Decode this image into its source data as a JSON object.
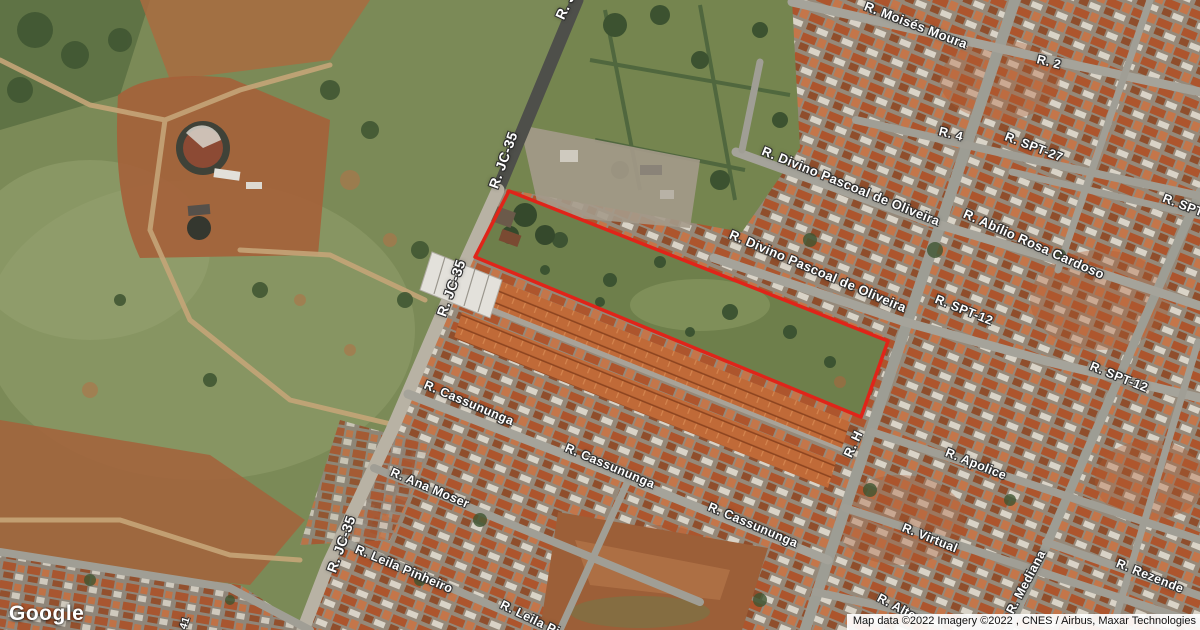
{
  "map": {
    "google_logo": "Google",
    "attribution": "Map data ©2022 Imagery ©2022 , CNES / Airbus, Maxar Technologies",
    "highlight": {
      "color": "#e02419",
      "points": [
        [
          509,
          191
        ],
        [
          888,
          341
        ],
        [
          861,
          417
        ],
        [
          475,
          257
        ]
      ]
    },
    "street_labels": [
      {
        "text": "R. Moisés Moura",
        "x": 916,
        "y": 25,
        "rot": 21,
        "size": 13
      },
      {
        "text": "R. 2",
        "x": 1049,
        "y": 62,
        "rot": 14,
        "size": 12.5
      },
      {
        "text": "R. 4",
        "x": 951,
        "y": 134,
        "rot": 14,
        "size": 12.5
      },
      {
        "text": "R. SPT-27",
        "x": 1034,
        "y": 147,
        "rot": 21,
        "size": 12.5
      },
      {
        "text": "R. SPT-",
        "x": 1185,
        "y": 206,
        "rot": 21,
        "size": 12.5
      },
      {
        "text": "R. Divino Pascoal de Oliveira",
        "x": 851,
        "y": 186,
        "rot": 22,
        "size": 13
      },
      {
        "text": "R. Divino Pascoal de Oliveira",
        "x": 818,
        "y": 271,
        "rot": 23,
        "size": 13
      },
      {
        "text": "R. Abílio Rosa Cardoso",
        "x": 1034,
        "y": 244,
        "rot": 24,
        "size": 13
      },
      {
        "text": "R. SPT-12",
        "x": 964,
        "y": 310,
        "rot": 22,
        "size": 12.5
      },
      {
        "text": "R. SPT-12",
        "x": 1119,
        "y": 377,
        "rot": 22,
        "size": 12.5
      },
      {
        "text": "R. J",
        "x": 565,
        "y": 6,
        "rot": -65,
        "size": 14
      },
      {
        "text": "R. JC-35",
        "x": 503,
        "y": 160,
        "rot": -70,
        "size": 14
      },
      {
        "text": "R. JC-35",
        "x": 451,
        "y": 288,
        "rot": -70,
        "size": 14
      },
      {
        "text": "R. JC-35",
        "x": 341,
        "y": 544,
        "rot": -70,
        "size": 14
      },
      {
        "text": "R. Cassununga",
        "x": 469,
        "y": 403,
        "rot": 23,
        "size": 12.5
      },
      {
        "text": "R. Cassununga",
        "x": 610,
        "y": 466,
        "rot": 23,
        "size": 12.5
      },
      {
        "text": "R. Cassununga",
        "x": 753,
        "y": 525,
        "rot": 23,
        "size": 12.5
      },
      {
        "text": "R. Ana Moser",
        "x": 430,
        "y": 488,
        "rot": 23,
        "size": 12.5
      },
      {
        "text": "R. Leila Pinheiro",
        "x": 404,
        "y": 569,
        "rot": 23,
        "size": 12.5
      },
      {
        "text": "R. Leila Pi",
        "x": 530,
        "y": 618,
        "rot": 26,
        "size": 12.5
      },
      {
        "text": "R. H",
        "x": 853,
        "y": 444,
        "rot": -65,
        "size": 13
      },
      {
        "text": "R. Apolice",
        "x": 976,
        "y": 464,
        "rot": 22,
        "size": 12.5
      },
      {
        "text": "R. Virtual",
        "x": 930,
        "y": 538,
        "rot": 22,
        "size": 12.5
      },
      {
        "text": "R. Mediana",
        "x": 1026,
        "y": 582,
        "rot": -62,
        "size": 12.5
      },
      {
        "text": "R. Rezende",
        "x": 1150,
        "y": 576,
        "rot": 22,
        "size": 12.5
      },
      {
        "text": "R. Alter",
        "x": 899,
        "y": 608,
        "rot": 28,
        "size": 12.5
      },
      {
        "text": "41",
        "x": 185,
        "y": 623,
        "rot": -72,
        "size": 10.5
      }
    ]
  }
}
